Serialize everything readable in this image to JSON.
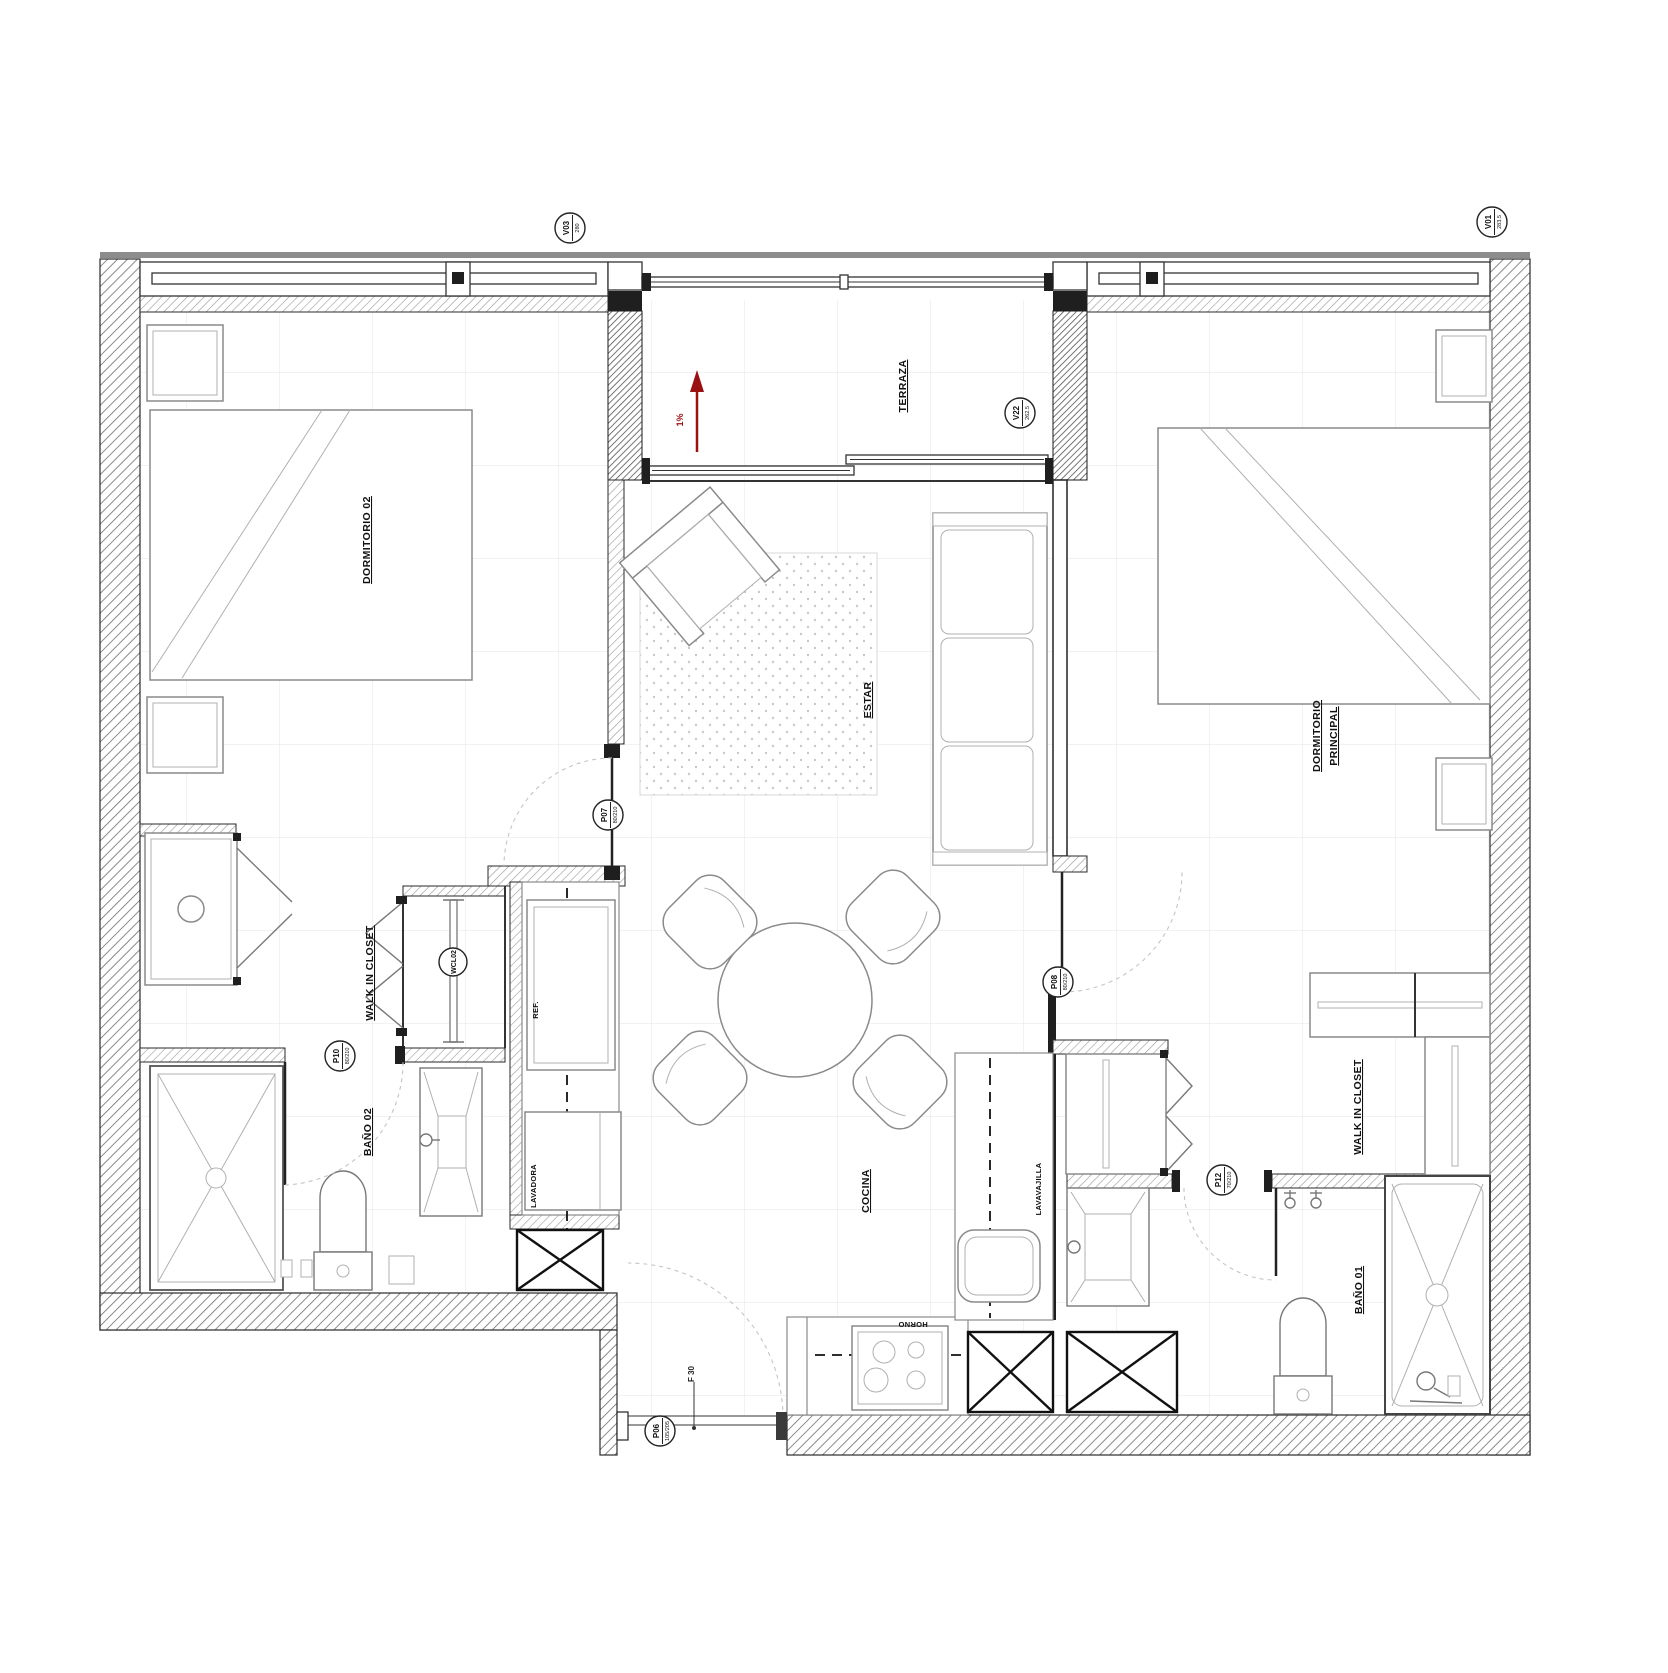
{
  "plan": {
    "rooms": {
      "dormitorio02": "DORMITORIO 02",
      "terraza": "TERRAZA",
      "dormitorio_principal_1": "DORMITORIO",
      "dormitorio_principal_2": "PRINCIPAL",
      "estar": "ESTAR",
      "cocina": "COCINA",
      "bano02": "BAÑO 02",
      "bano01": "BAÑO 01",
      "wic_left": "WALK IN CLOSET",
      "wic_right": "WALK IN CLOSET"
    },
    "appliances": {
      "fridge": "REF.",
      "washer": "LAVADORA",
      "dishwasher": "LAVAVAJILLA",
      "oven": "HORNO"
    },
    "door_tags": {
      "p06": {
        "code": "P06",
        "size": "105/205"
      },
      "p07": {
        "code": "P07",
        "size": "80/210"
      },
      "p08": {
        "code": "P08",
        "size": "80/210"
      },
      "p10": {
        "code": "P10",
        "size": "80/210"
      },
      "p12": {
        "code": "P12",
        "size": "70/210"
      }
    },
    "window_tags": {
      "v03": {
        "code": "V03",
        "size": "280"
      },
      "v22": {
        "code": "V22",
        "size": "262.5"
      },
      "v01": {
        "code": "V01",
        "size": "283.5"
      }
    },
    "annotations": {
      "slope": "1%",
      "fire_rating": "F 30",
      "closet_tag": "WCL02"
    },
    "colors": {
      "slope_arrow": "#991111",
      "wall_line": "#2a2a2a"
    }
  }
}
